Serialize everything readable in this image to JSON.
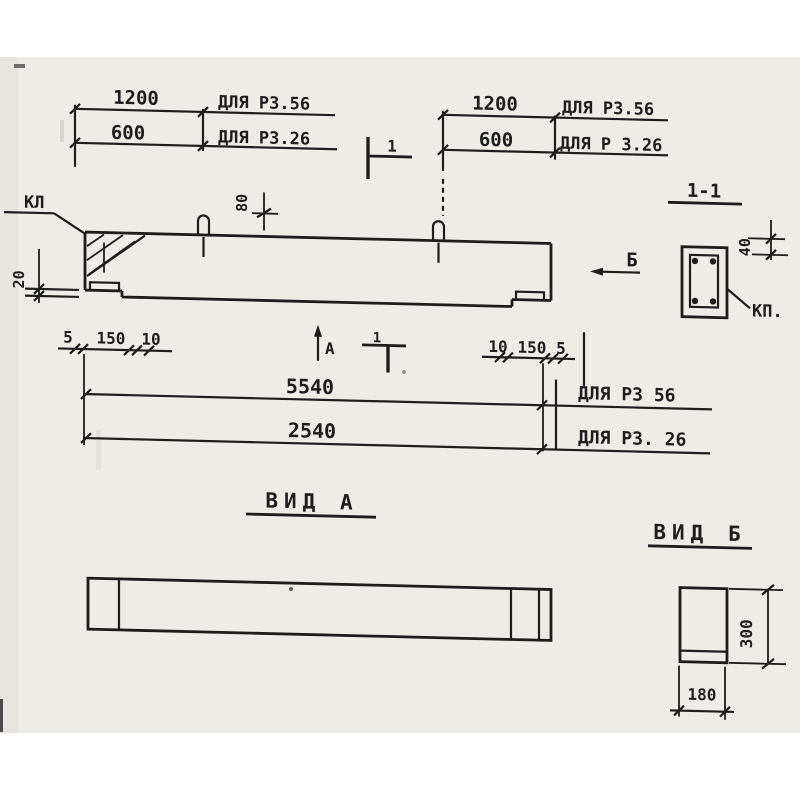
{
  "colors": {
    "paper": "#eeece7",
    "ink": "#1d1d1d",
    "page": "#ffffff"
  },
  "top_left_group": {
    "rows": [
      {
        "value": "1200",
        "label": "ДЛЯ РЗ.56"
      },
      {
        "value": "600",
        "label": "ДЛЯ РЗ.26"
      }
    ]
  },
  "top_right_group": {
    "rows": [
      {
        "value": "1200",
        "label": "ДЛЯ РЗ.56"
      },
      {
        "value": "600",
        "label": "ДЛЯ Р 3.26"
      }
    ]
  },
  "section_cut": {
    "top_label": "1",
    "bottom_label": "1",
    "title": "1-1"
  },
  "view_arrows": {
    "a": "А",
    "b": "Б"
  },
  "callouts": {
    "kl": "КЛ",
    "kp": "КП."
  },
  "front_dims": {
    "d20": "20",
    "d80": "80",
    "left_row": [
      "5",
      "150",
      "10"
    ],
    "right_row": [
      "10",
      "150",
      "5"
    ]
  },
  "length_rows": [
    {
      "value": "5540",
      "label": "ДЛЯ РЗ 56"
    },
    {
      "value": "2540",
      "label": "ДЛЯ РЗ. 26"
    }
  ],
  "section_detail": {
    "d40": "40"
  },
  "titles": {
    "view_a": "ВИД А",
    "view_b": "ВИД Б"
  },
  "view_b_dims": {
    "height": "300",
    "width": "180"
  }
}
